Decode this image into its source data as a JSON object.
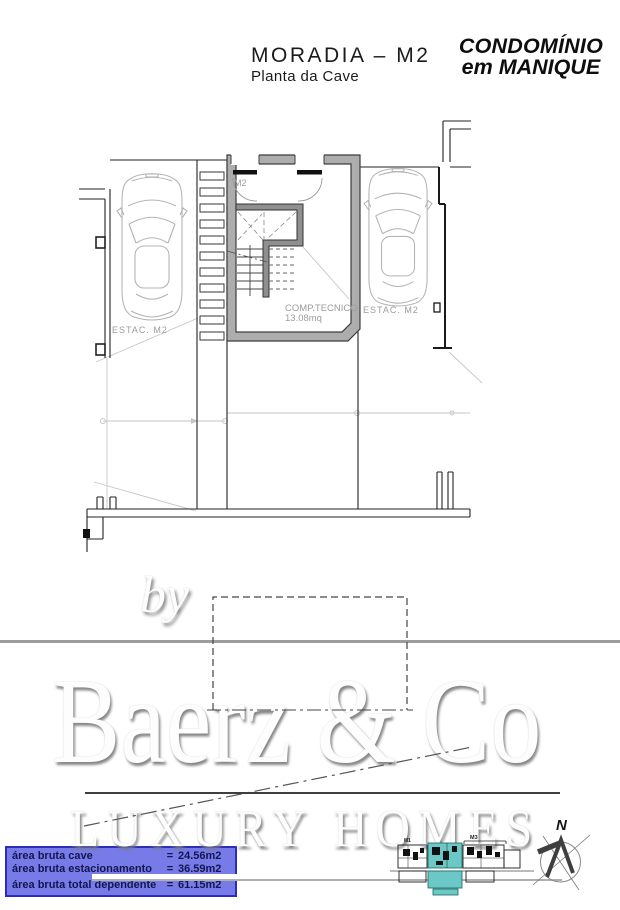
{
  "header": {
    "title": "MORADIA – M2",
    "subtitle": "Planta da Cave",
    "logo_line1": "CONDOMÍNIO",
    "logo_line2": "em MANIQUE"
  },
  "plan": {
    "stair_room_label": "M2",
    "parking_left_label": "ESTAC.  M2",
    "parking_right_label": "ESTAC.  M2",
    "tech_room_name": "COMP.TECNICO",
    "tech_room_area": "13.08mq"
  },
  "legend": {
    "rows": [
      {
        "label": "área bruta cave",
        "eq": "=",
        "value": "24.56m2"
      },
      {
        "label": "área bruta estacionamento",
        "eq": "=",
        "value": "36.59m2"
      },
      {
        "label": "área bruta total dependente",
        "eq": "=",
        "value": "61.15m2"
      }
    ]
  },
  "watermark": {
    "by": "by",
    "brand": "Baerz & Co",
    "tagline": "LUXURY HOMES"
  },
  "site_plan": {
    "left_unit_label": "M1",
    "right_unit_label": "M3",
    "highlight_color": "#6cc7c7"
  },
  "compass": {
    "north_label": "N"
  },
  "colors": {
    "legend_bg": "#767be8",
    "legend_border": "#2d2dbb",
    "highlight_teal": "#6cc7c7"
  }
}
